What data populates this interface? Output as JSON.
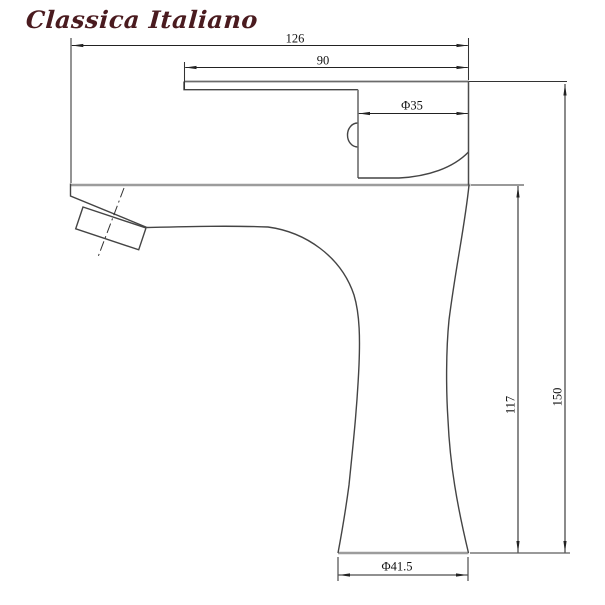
{
  "logo": {
    "text": "Classica Italiano",
    "color": "#4a1b1f"
  },
  "drawing": {
    "subject": "Single-handle basin faucet, side elevation",
    "dimensions": {
      "overall_width": "126",
      "handle_length": "90",
      "cartridge_diameter": "Φ35",
      "spout_height": "117",
      "overall_height": "150",
      "base_diameter": "Φ41.5"
    },
    "line_colors": {
      "outline": "#444444",
      "thick_edge": "#9c9c9c",
      "dimension": "#333333"
    }
  }
}
